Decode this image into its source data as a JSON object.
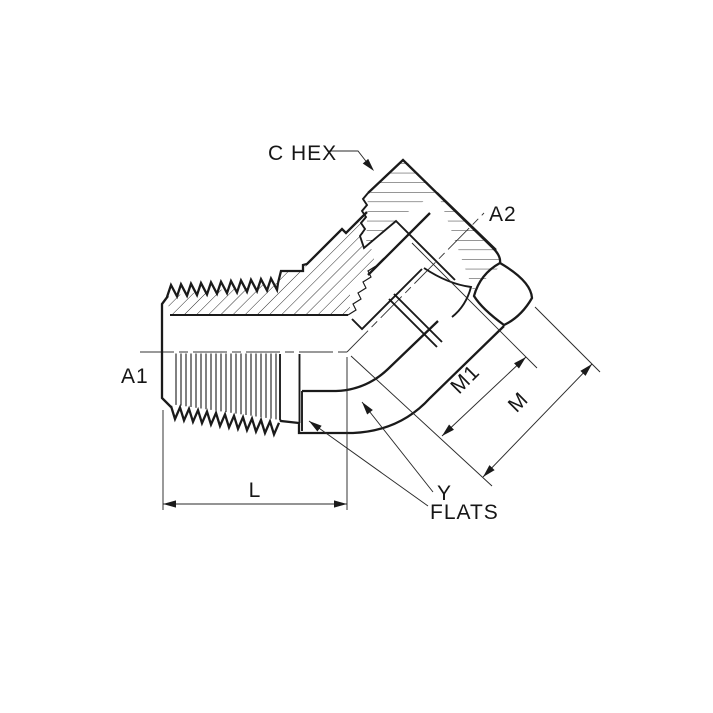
{
  "diagram": {
    "type": "technical-drawing",
    "subject": "45-degree elbow hydraulic adapter, male pipe thread by female swivel, half-section view",
    "background_color": "#ffffff",
    "line_color": "#1a1a1a",
    "labels": {
      "c_hex": "C HEX",
      "a2": "A2",
      "a1": "A1",
      "l": "L",
      "m1": "M1",
      "m": "M",
      "y": "Y",
      "flats": "FLATS"
    }
  }
}
